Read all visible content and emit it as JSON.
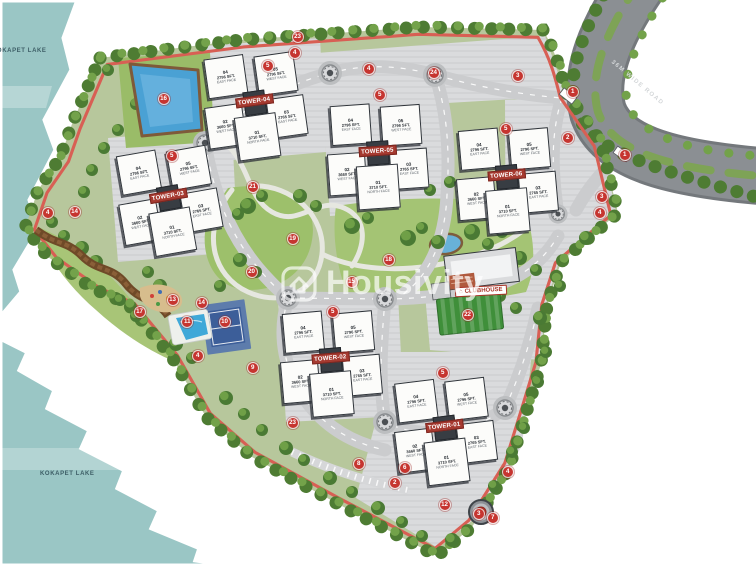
{
  "watermark": {
    "brand": "Housivity"
  },
  "lakes": {
    "top_label": "KOKAPET LAKE",
    "bottom_label": "KOKAPET LAKE"
  },
  "road": {
    "label": "36M WIDE ROAD"
  },
  "clubhouse": {
    "label": "CLUBHOUSE"
  },
  "colors": {
    "lake": "#9ac6c5",
    "parcel_green": "#b7c79c",
    "lawn": "#9dc06b",
    "tree_dark": "#4a7a34",
    "tree_light": "#6f9f47",
    "road_internal": "#cbccce",
    "road_external": "#8b8f93",
    "track_red": "#d85f54",
    "marker_red": "#c63530",
    "tower_plate_red": "#a63a30",
    "building_white": "#fcfcfa",
    "building_edge": "#2f343a",
    "water_blue": "#4aa1d4",
    "court_blue": "#3c5e99"
  },
  "towers": [
    {
      "name": "TOWER-04",
      "x": 204,
      "y": 49,
      "rot": -8,
      "units": [
        {
          "no": "04",
          "area": "2796 SFT.",
          "facing": "EAST FACE"
        },
        {
          "no": "05",
          "area": "2796 SFT.",
          "facing": "WEST FACE"
        },
        {
          "no": "02",
          "area": "3660 SFT.",
          "facing": "WEST FACE"
        },
        {
          "no": "03",
          "area": "2765 SFT.",
          "facing": "EAST FACE"
        },
        {
          "no": "01",
          "area": "3710 SFT.",
          "facing": "NORTH FACE"
        }
      ]
    },
    {
      "name": "TOWER-03",
      "x": 118,
      "y": 144,
      "rot": -10,
      "units": [
        {
          "no": "04",
          "area": "2796 SFT.",
          "facing": "EAST FACE"
        },
        {
          "no": "05",
          "area": "2796 SFT.",
          "facing": "WEST FACE"
        },
        {
          "no": "02",
          "area": "3660 SFT.",
          "facing": "WEST FACE"
        },
        {
          "no": "03",
          "area": "2765 SFT.",
          "facing": "EAST FACE"
        },
        {
          "no": "01",
          "area": "3710 SFT.",
          "facing": "NORTH FACE"
        }
      ]
    },
    {
      "name": "TOWER-05",
      "x": 327,
      "y": 99,
      "rot": -4,
      "units": [
        {
          "no": "04",
          "area": "2796 SFT.",
          "facing": "EAST FACE"
        },
        {
          "no": "05",
          "area": "2796 SFT.",
          "facing": "WEST FACE"
        },
        {
          "no": "02",
          "area": "3660 SFT.",
          "facing": "WEST FACE"
        },
        {
          "no": "03",
          "area": "2765 SFT.",
          "facing": "EAST FACE"
        },
        {
          "no": "01",
          "area": "3710 SFT.",
          "facing": "NORTH FACE"
        }
      ]
    },
    {
      "name": "TOWER-06",
      "x": 456,
      "y": 123,
      "rot": -5,
      "units": [
        {
          "no": "04",
          "area": "2796 SFT.",
          "facing": "EAST FACE"
        },
        {
          "no": "05",
          "area": "2796 SFT.",
          "facing": "WEST FACE"
        },
        {
          "no": "02",
          "area": "3660 SFT.",
          "facing": "WEST FACE"
        },
        {
          "no": "03",
          "area": "2765 SFT.",
          "facing": "EAST FACE"
        },
        {
          "no": "01",
          "area": "3710 SFT.",
          "facing": "NORTH FACE"
        }
      ]
    },
    {
      "name": "TOWER-02",
      "x": 280,
      "y": 306,
      "rot": -5,
      "units": [
        {
          "no": "04",
          "area": "2796 SFT.",
          "facing": "EAST FACE"
        },
        {
          "no": "05",
          "area": "2796 SFT.",
          "facing": "WEST FACE"
        },
        {
          "no": "02",
          "area": "3660 SFT.",
          "facing": "WEST FACE"
        },
        {
          "no": "03",
          "area": "2765 SFT.",
          "facing": "EAST FACE"
        },
        {
          "no": "01",
          "area": "3710 SFT.",
          "facing": "NORTH FACE"
        }
      ]
    },
    {
      "name": "TOWER-01",
      "x": 394,
      "y": 374,
      "rot": -7,
      "units": [
        {
          "no": "04",
          "area": "2796 SFT.",
          "facing": "EAST FACE"
        },
        {
          "no": "05",
          "area": "2796 SFT.",
          "facing": "WEST FACE"
        },
        {
          "no": "02",
          "area": "3660 SFT.",
          "facing": "WEST FACE"
        },
        {
          "no": "03",
          "area": "2765 SFT.",
          "facing": "EAST FACE"
        },
        {
          "no": "01",
          "area": "3710 SFT.",
          "facing": "NORTH FACE"
        }
      ]
    }
  ],
  "markers": [
    {
      "n": "23",
      "x": 298,
      "y": 37
    },
    {
      "n": "4",
      "x": 295,
      "y": 53
    },
    {
      "n": "4",
      "x": 369,
      "y": 69
    },
    {
      "n": "24",
      "x": 434,
      "y": 73
    },
    {
      "n": "3",
      "x": 518,
      "y": 76
    },
    {
      "n": "5",
      "x": 268,
      "y": 66
    },
    {
      "n": "5",
      "x": 380,
      "y": 95
    },
    {
      "n": "5",
      "x": 506,
      "y": 129
    },
    {
      "n": "5",
      "x": 172,
      "y": 156
    },
    {
      "n": "5",
      "x": 333,
      "y": 312
    },
    {
      "n": "5",
      "x": 443,
      "y": 373
    },
    {
      "n": "1",
      "x": 573,
      "y": 92
    },
    {
      "n": "2",
      "x": 568,
      "y": 138
    },
    {
      "n": "1",
      "x": 625,
      "y": 155
    },
    {
      "n": "3",
      "x": 602,
      "y": 197
    },
    {
      "n": "4",
      "x": 600,
      "y": 213
    },
    {
      "n": "16",
      "x": 164,
      "y": 99
    },
    {
      "n": "4",
      "x": 48,
      "y": 213
    },
    {
      "n": "14",
      "x": 75,
      "y": 212
    },
    {
      "n": "21",
      "x": 253,
      "y": 187
    },
    {
      "n": "20",
      "x": 252,
      "y": 272
    },
    {
      "n": "19",
      "x": 293,
      "y": 239
    },
    {
      "n": "18",
      "x": 389,
      "y": 260
    },
    {
      "n": "15",
      "x": 352,
      "y": 282
    },
    {
      "n": "17",
      "x": 140,
      "y": 312
    },
    {
      "n": "13",
      "x": 173,
      "y": 300
    },
    {
      "n": "14",
      "x": 202,
      "y": 303
    },
    {
      "n": "11",
      "x": 187,
      "y": 322
    },
    {
      "n": "10",
      "x": 225,
      "y": 322
    },
    {
      "n": "4",
      "x": 198,
      "y": 356
    },
    {
      "n": "9",
      "x": 253,
      "y": 368
    },
    {
      "n": "23",
      "x": 293,
      "y": 423
    },
    {
      "n": "8",
      "x": 359,
      "y": 464
    },
    {
      "n": "6",
      "x": 405,
      "y": 468
    },
    {
      "n": "2",
      "x": 395,
      "y": 483
    },
    {
      "n": "12",
      "x": 445,
      "y": 505
    },
    {
      "n": "3",
      "x": 479,
      "y": 514
    },
    {
      "n": "7",
      "x": 493,
      "y": 518
    },
    {
      "n": "4",
      "x": 508,
      "y": 472
    },
    {
      "n": "22",
      "x": 468,
      "y": 315
    }
  ]
}
